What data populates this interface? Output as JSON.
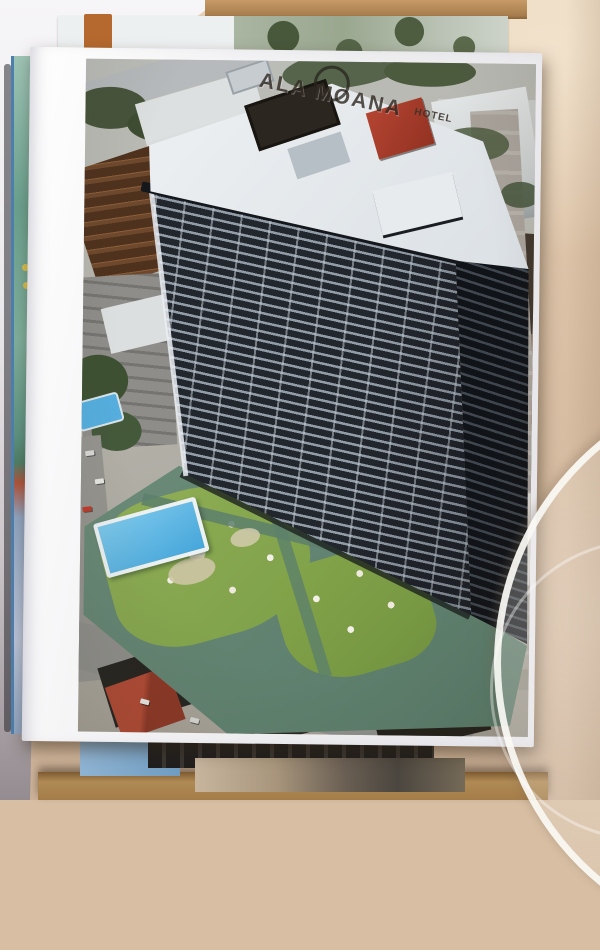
{
  "scene": {
    "description": "Photograph of a stack of postcards leaning against a wall; the top postcard shows an oblique aerial view of a dark high-rise hotel tower with a rooftop sign, a pool terrace with lawns, and surrounding city streets.",
    "setting": "postcards on a wooden shelf between a white wall (left) and a beige wall (right), with the rim of a round glass object at the lower right"
  },
  "postcard": {
    "rooftop_sign": {
      "text": "ALA MOANA",
      "secondary": "HOTEL"
    }
  },
  "palette": {
    "wall_left": "#f2f1f3",
    "wall_right": "#d8bfa4",
    "shelf": "#b08a55",
    "card_border": "#f1f0f2",
    "tower_dark": "#23262c",
    "tower_stripe": "#97a1ab",
    "roof": "#e3e7ea",
    "sign_red": "#a63a28",
    "deck": "#6f8d7a",
    "lawn": "#8cab50",
    "pool": "#54b2e0",
    "street": "#8f8f8b",
    "red_roof": "#a8432f",
    "side_card_teal": "#7fae9c",
    "bottom_card_blue": "#7fa9cc",
    "tab_orange": "#b5692f"
  }
}
